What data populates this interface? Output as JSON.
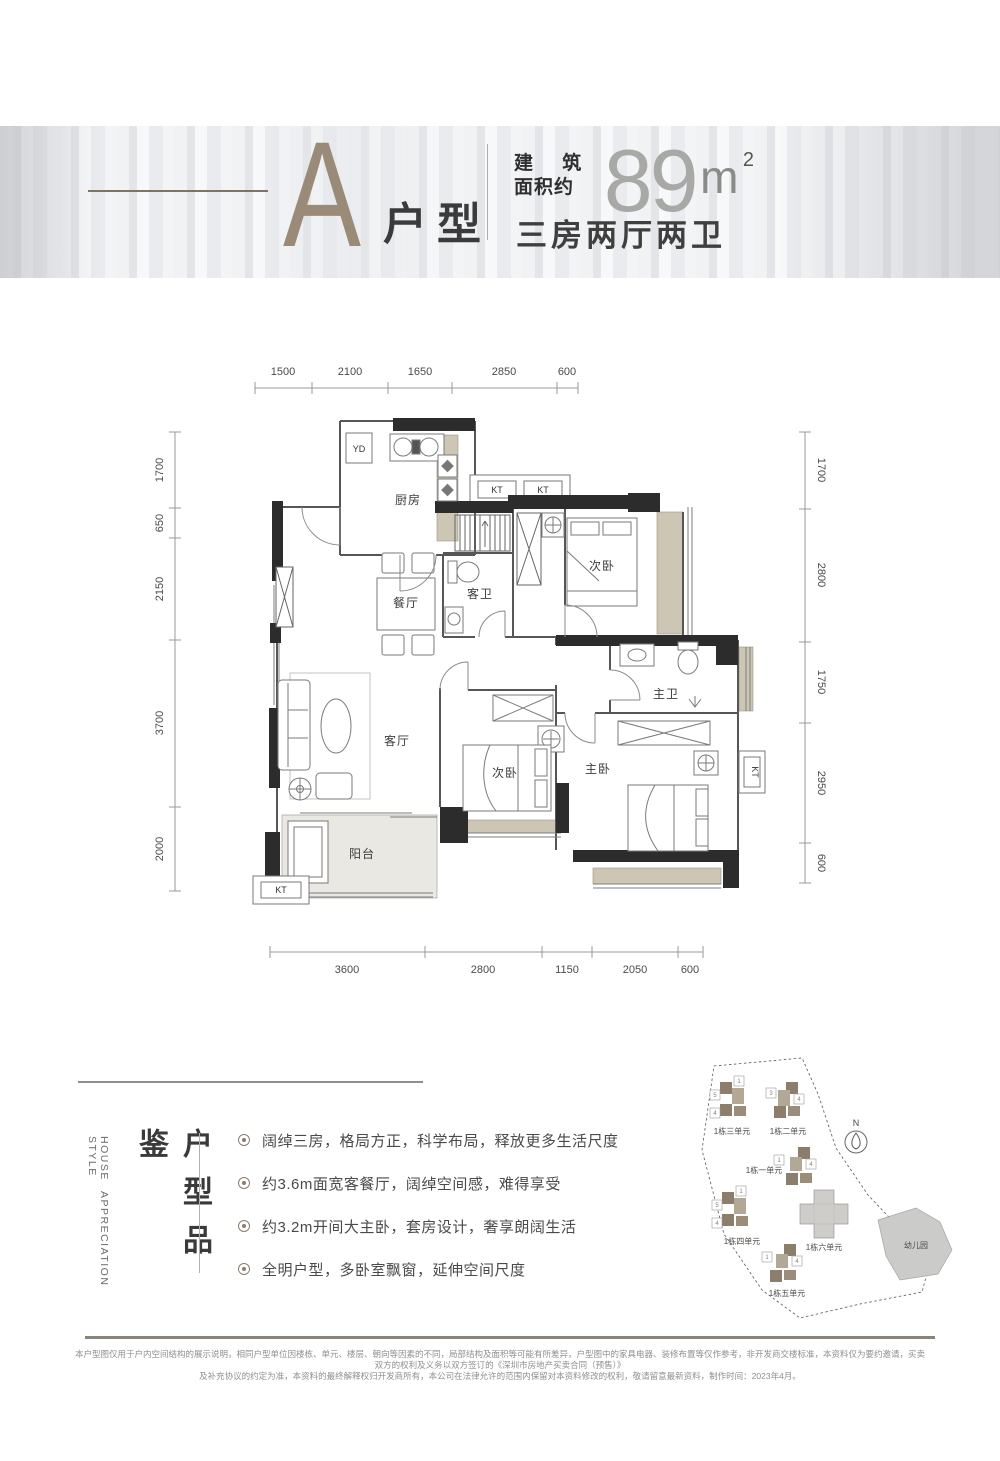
{
  "header": {
    "type_letter": "A",
    "type_suffix": "户型",
    "area_label_line1": "建 筑",
    "area_label_line2": "面积约",
    "area_value": "89",
    "area_unit_base": "m",
    "area_unit_sup": "2",
    "spec": "三房两厅两卫"
  },
  "plan": {
    "dims_top": [
      "1500",
      "2100",
      "1650",
      "2850",
      "600"
    ],
    "dims_left": [
      "1700",
      "650",
      "2150",
      "3700",
      "2000"
    ],
    "dims_right": [
      "1700",
      "2800",
      "1750",
      "2950",
      "600"
    ],
    "dims_bottom": [
      "3600",
      "2800",
      "1150",
      "2050",
      "600"
    ],
    "labels": {
      "kitchen": "厨房",
      "dining": "餐厅",
      "guest_bath": "客卫",
      "secondary_bedroom": "次卧",
      "master_bedroom": "主卧",
      "master_bath": "主卫",
      "living": "客厅",
      "balcony": "阳台",
      "yd": "YD",
      "kt": "KT"
    }
  },
  "appreciation": {
    "en_line1": "HOUSE STYLE",
    "en_line2": "APPRECIATION",
    "cn_title": "户型品鉴",
    "bullets": [
      "阔绰三房，格局方正，科学布局，释放更多生活尺度",
      "约3.6m面宽客餐厅，阔绰空间感，难得享受",
      "约3.2m开间大主卧，套房设计，奢享朗阔生活",
      "全明户型，多卧室飘窗，延伸空间尺度"
    ]
  },
  "sitemap": {
    "compass": "N",
    "kindergarten": "幼儿园",
    "clusters": [
      {
        "label": "1栋三单元",
        "chips": [
          "5",
          "1",
          "4"
        ]
      },
      {
        "label": "1栋二单元",
        "chips": [
          "3",
          "4"
        ]
      },
      {
        "label": "1栋一单元",
        "chips": [
          "1",
          "4"
        ]
      },
      {
        "label": "1栋四单元",
        "chips": [
          "5",
          "1",
          "4"
        ]
      },
      {
        "label": "1栋六单元",
        "chips": []
      },
      {
        "label": "1栋五单元",
        "chips": [
          "1",
          "4"
        ]
      }
    ]
  },
  "footer": {
    "line1": "本户型图仅用于户内空间结构的展示说明，相同户型单位因楼栋、单元、楼层、朝向等因素的不同，局部结构及面积等可能有所差异，户型图中的家具电器、装修布置等仅作参考，非开发商交楼标准，本资料仅为要约邀请，买卖双方的权利及义务以双方签订的《深圳市房地产买卖合同（预售）》",
    "line2": "及补充协议的约定为准，本资料的最终解释权归开发商所有，本公司在法律允许的范围内保留对本资料修改的权利，敬请留意最新资料，制作时间：2023年4月。"
  },
  "colors": {
    "accent": "#9a8b79",
    "wall": "#2c2c2c",
    "beige": "#cdc6b4",
    "bullet_brown": "#8b7d6b"
  }
}
